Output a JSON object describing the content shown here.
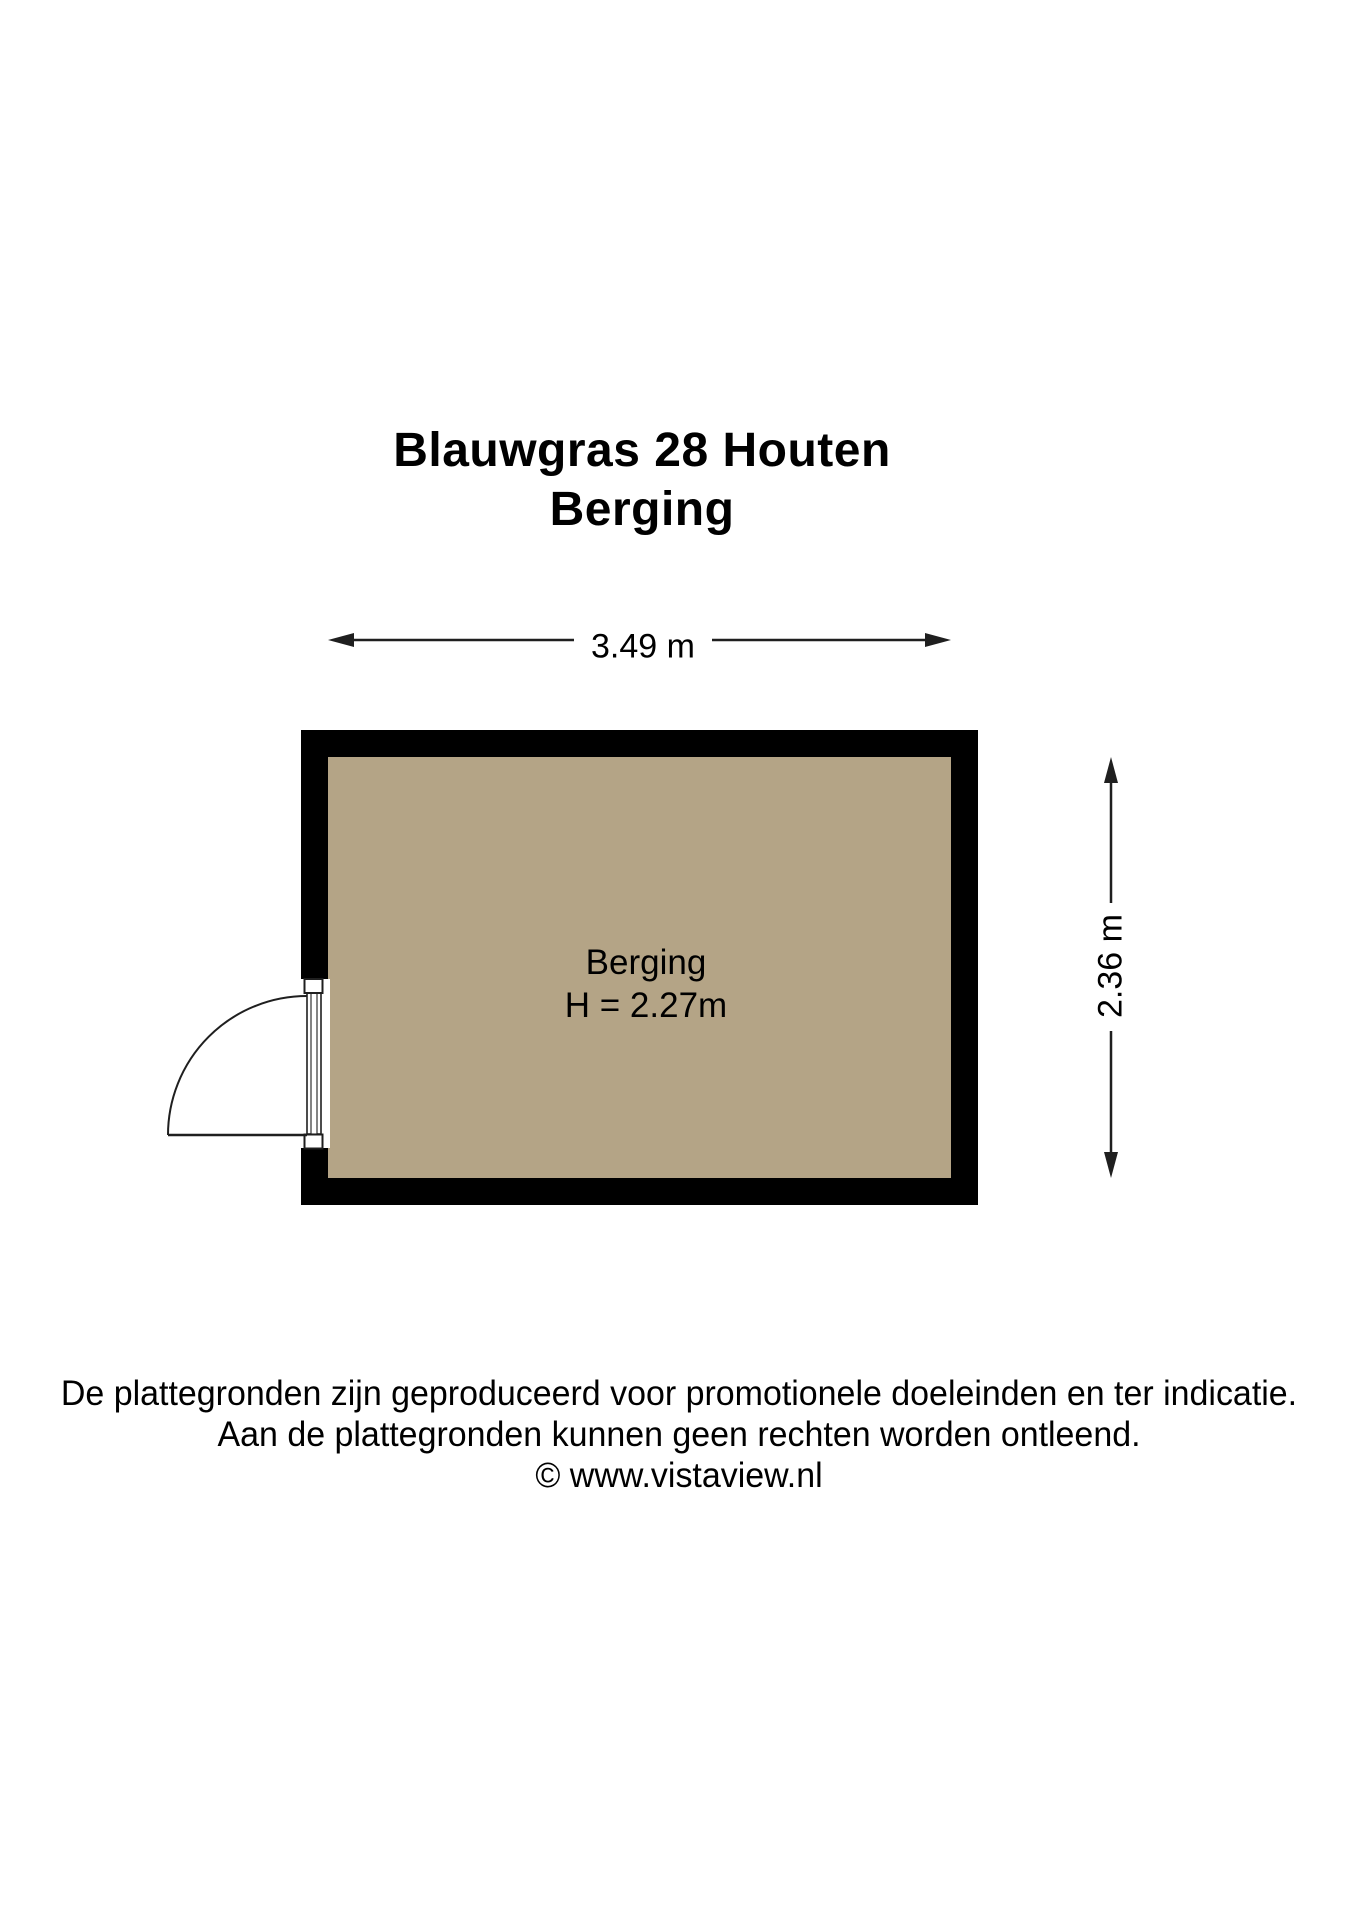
{
  "title": {
    "address": "Blauwgras 28 Houten",
    "floor": "Berging"
  },
  "dimensions": {
    "width": "3.49 m",
    "height": "2.36 m"
  },
  "room": {
    "name": "Berging",
    "ceiling_height": "H = 2.27m"
  },
  "footer": {
    "line1": "De plattegronden zijn geproduceerd voor promotionele doeleinden en ter indicatie.",
    "line2": "Aan de plattegronden kunnen geen rechten worden ontleend.",
    "copyright": "© www.vistaview.nl"
  },
  "colors": {
    "wall": "#000000",
    "floor": "#b4a486",
    "line": "#1f1f1f",
    "background": "#ffffff"
  }
}
